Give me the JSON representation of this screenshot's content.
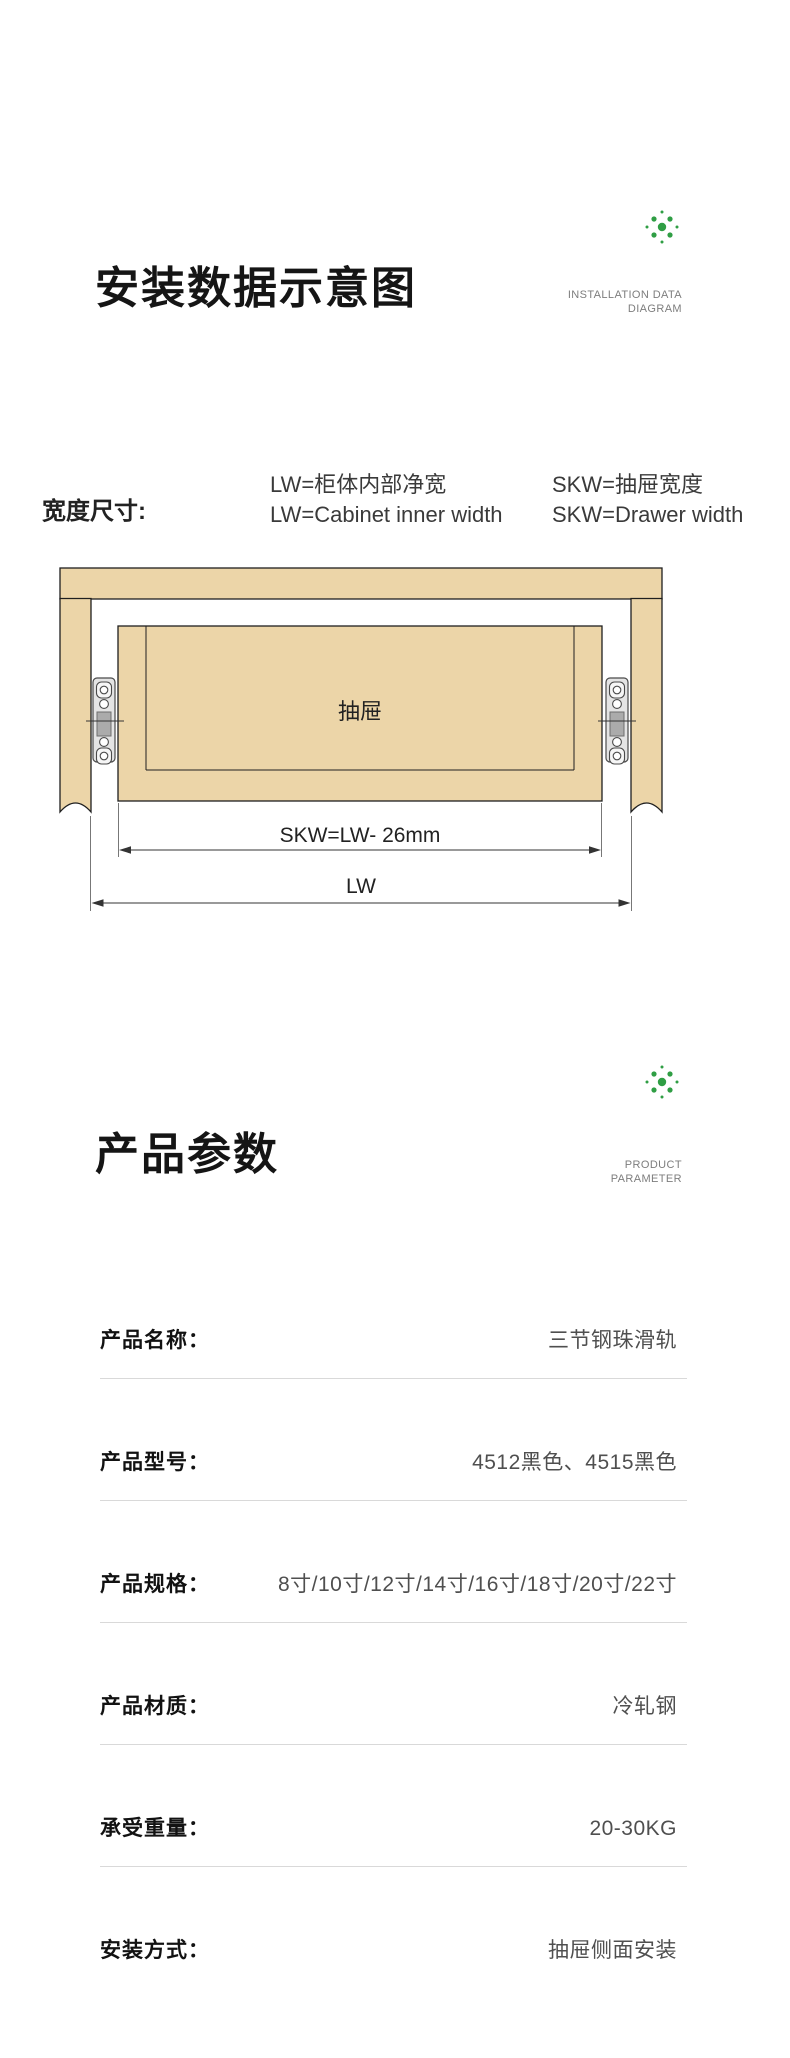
{
  "colors": {
    "accent_green": "#2f9e44",
    "wood_tan": "#ecd5a8",
    "outline_black": "#1f1f1f",
    "divider_gray": "#d9d9d9",
    "caption_gray": "#7d7d7d",
    "value_gray": "#4f4f4f"
  },
  "section_installation": {
    "title": "安装数据示意图",
    "caption_line1": "INSTALLATION DATA",
    "caption_line2": "DIAGRAM",
    "legend": {
      "heading": "宽度尺寸:",
      "col1_line1": "LW=柜体内部净宽",
      "col1_line2": "LW=Cabinet inner width",
      "col2_line1": "SKW=抽屉宽度",
      "col2_line2": "SKW=Drawer width"
    },
    "diagram": {
      "drawer_label": "抽屉",
      "dim_skw": "SKW=LW- 26mm",
      "dim_lw": "LW"
    }
  },
  "section_parameters": {
    "title": "产品参数",
    "caption_line1": "PRODUCT",
    "caption_line2": "PARAMETER",
    "rows": [
      {
        "label": "产品名称：",
        "value": "三节钢珠滑轨"
      },
      {
        "label": "产品型号：",
        "value": "4512黑色、4515黑色"
      },
      {
        "label": "产品规格：",
        "value": "8寸/10寸/12寸/14寸/16寸/18寸/20寸/22寸"
      },
      {
        "label": "产品材质：",
        "value": "冷轧钢"
      },
      {
        "label": "承受重量：",
        "value": "20-30KG"
      },
      {
        "label": "安装方式：",
        "value": "抽屉侧面安装"
      }
    ]
  }
}
